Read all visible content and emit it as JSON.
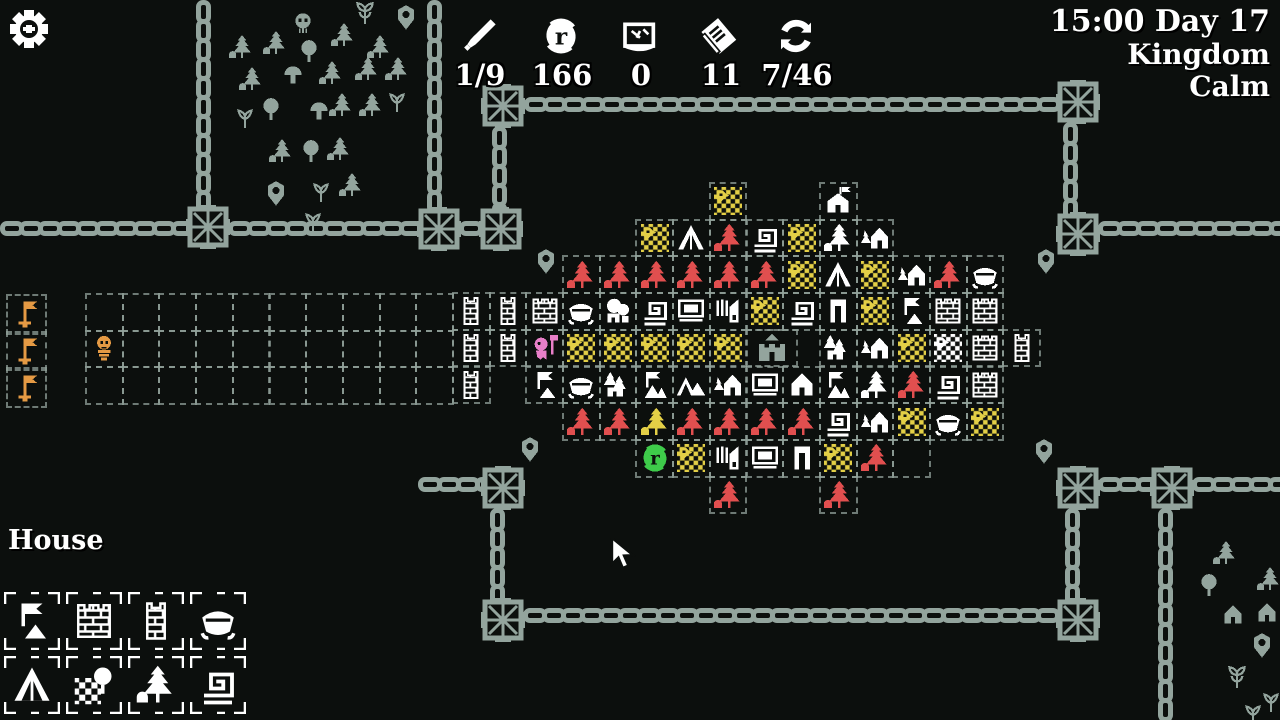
{
  "hud": {
    "resources": [
      {
        "icon": "sword-icon",
        "value": "1/9",
        "cx": 480
      },
      {
        "icon": "coin-icon",
        "value": "166",
        "cx": 562
      },
      {
        "icon": "map-icon",
        "value": "0",
        "cx": 641
      },
      {
        "icon": "deck-icon",
        "value": "11",
        "cx": 721
      },
      {
        "icon": "cycle-icon",
        "value": "7/46",
        "cx": 797
      }
    ],
    "clock": "15:00 Day 17",
    "region": "Kingdom",
    "status": "Calm"
  },
  "selection": {
    "label": "House",
    "items": [
      {
        "name": "banner",
        "col": 0,
        "row": 0
      },
      {
        "name": "wall",
        "col": 1,
        "row": 0
      },
      {
        "name": "tower",
        "col": 2,
        "row": 0
      },
      {
        "name": "boat",
        "col": 3,
        "row": 0
      },
      {
        "name": "tent",
        "col": 0,
        "row": 1
      },
      {
        "name": "white-field",
        "col": 1,
        "row": 1
      },
      {
        "name": "white-forest",
        "col": 2,
        "row": 1
      },
      {
        "name": "spiral",
        "col": 3,
        "row": 1
      }
    ]
  },
  "colors": {
    "yellow": "#e3cf46",
    "red": "#e14f4f",
    "orange": "#e59a44",
    "pink": "#e87fc8",
    "green": "#3ecb4a",
    "gray": "#93a49d",
    "white": "#ffffff",
    "bg": "#0c0f0d",
    "grid": "#94a49d"
  },
  "map": {
    "origin": {
      "x": 562,
      "y": 182
    },
    "cell": 36.7,
    "tiles": [
      {
        "c": 4,
        "r": 0,
        "t": "farm"
      },
      {
        "c": 7,
        "r": 0,
        "t": "house-flag"
      },
      {
        "c": 2,
        "r": 1,
        "t": "farm"
      },
      {
        "c": 3,
        "r": 1,
        "t": "tent"
      },
      {
        "c": 4,
        "r": 1,
        "t": "red-pine"
      },
      {
        "c": 5,
        "r": 1,
        "t": "spiral"
      },
      {
        "c": 6,
        "r": 1,
        "t": "farm"
      },
      {
        "c": 7,
        "r": 1,
        "t": "white-pine"
      },
      {
        "c": 8,
        "r": 1,
        "t": "house-tree"
      },
      {
        "c": 0,
        "r": 2,
        "t": "red-pine"
      },
      {
        "c": 1,
        "r": 2,
        "t": "red-pine"
      },
      {
        "c": 2,
        "r": 2,
        "t": "red-pine"
      },
      {
        "c": 3,
        "r": 2,
        "t": "red-pine"
      },
      {
        "c": 4,
        "r": 2,
        "t": "red-pine"
      },
      {
        "c": 5,
        "r": 2,
        "t": "red-pine"
      },
      {
        "c": 6,
        "r": 2,
        "t": "farm"
      },
      {
        "c": 7,
        "r": 2,
        "t": "tent"
      },
      {
        "c": 8,
        "r": 2,
        "t": "farm"
      },
      {
        "c": 9,
        "r": 2,
        "t": "house-tree"
      },
      {
        "c": 10,
        "r": 2,
        "t": "red-pine"
      },
      {
        "c": 11,
        "r": 2,
        "t": "boat"
      },
      {
        "c": -3,
        "r": 3,
        "t": "tower"
      },
      {
        "c": -2,
        "r": 3,
        "t": "tower"
      },
      {
        "c": -1,
        "r": 3,
        "t": "wall"
      },
      {
        "c": 0,
        "r": 3,
        "t": "boat"
      },
      {
        "c": 1,
        "r": 3,
        "t": "quarry"
      },
      {
        "c": 2,
        "r": 3,
        "t": "spiral"
      },
      {
        "c": 3,
        "r": 3,
        "t": "market"
      },
      {
        "c": 4,
        "r": 3,
        "t": "mill"
      },
      {
        "c": 5,
        "r": 3,
        "t": "farm"
      },
      {
        "c": 6,
        "r": 3,
        "t": "spiral"
      },
      {
        "c": 7,
        "r": 3,
        "t": "door"
      },
      {
        "c": 8,
        "r": 3,
        "t": "farm"
      },
      {
        "c": 9,
        "r": 3,
        "t": "banner"
      },
      {
        "c": 10,
        "r": 3,
        "t": "wall"
      },
      {
        "c": 11,
        "r": 3,
        "t": "wall"
      },
      {
        "c": -3,
        "r": 4,
        "t": "tower"
      },
      {
        "c": -2,
        "r": 4,
        "t": "tower"
      },
      {
        "c": -1,
        "r": 4,
        "t": "pink-worker"
      },
      {
        "c": 0,
        "r": 4,
        "t": "farm"
      },
      {
        "c": 1,
        "r": 4,
        "t": "farm"
      },
      {
        "c": 2,
        "r": 4,
        "t": "farm"
      },
      {
        "c": 3,
        "r": 4,
        "t": "farm"
      },
      {
        "c": 4,
        "r": 4,
        "t": "farm"
      },
      {
        "c": 5,
        "r": 4,
        "t": "castle"
      },
      {
        "c": 7,
        "r": 4,
        "t": "pines-house"
      },
      {
        "c": 8,
        "r": 4,
        "t": "house-tree"
      },
      {
        "c": 9,
        "r": 4,
        "t": "farm"
      },
      {
        "c": 10,
        "r": 4,
        "t": "white-farm"
      },
      {
        "c": 11,
        "r": 4,
        "t": "wall"
      },
      {
        "c": 12,
        "r": 4,
        "t": "tower"
      },
      {
        "c": -3,
        "r": 5,
        "t": "tower"
      },
      {
        "c": -1,
        "r": 5,
        "t": "banner"
      },
      {
        "c": 0,
        "r": 5,
        "t": "boat"
      },
      {
        "c": 1,
        "r": 5,
        "t": "pines-house"
      },
      {
        "c": 2,
        "r": 5,
        "t": "flag-bldg"
      },
      {
        "c": 3,
        "r": 5,
        "t": "double-tent"
      },
      {
        "c": 4,
        "r": 5,
        "t": "house-tree"
      },
      {
        "c": 5,
        "r": 5,
        "t": "market"
      },
      {
        "c": 6,
        "r": 5,
        "t": "house"
      },
      {
        "c": 7,
        "r": 5,
        "t": "flag-bldg"
      },
      {
        "c": 8,
        "r": 5,
        "t": "white-pine"
      },
      {
        "c": 9,
        "r": 5,
        "t": "red-pine"
      },
      {
        "c": 10,
        "r": 5,
        "t": "spiral"
      },
      {
        "c": 11,
        "r": 5,
        "t": "wall"
      },
      {
        "c": 0,
        "r": 6,
        "t": "red-pine"
      },
      {
        "c": 1,
        "r": 6,
        "t": "red-pine"
      },
      {
        "c": 2,
        "r": 6,
        "t": "yellow-pine"
      },
      {
        "c": 3,
        "r": 6,
        "t": "red-pine"
      },
      {
        "c": 4,
        "r": 6,
        "t": "red-pine"
      },
      {
        "c": 5,
        "r": 6,
        "t": "red-pine"
      },
      {
        "c": 6,
        "r": 6,
        "t": "red-pine"
      },
      {
        "c": 7,
        "r": 6,
        "t": "spiral"
      },
      {
        "c": 8,
        "r": 6,
        "t": "house-tree"
      },
      {
        "c": 9,
        "r": 6,
        "t": "farm"
      },
      {
        "c": 10,
        "r": 6,
        "t": "boat"
      },
      {
        "c": 11,
        "r": 6,
        "t": "farm"
      },
      {
        "c": 2,
        "r": 7,
        "t": "green-coin"
      },
      {
        "c": 3,
        "r": 7,
        "t": "farm"
      },
      {
        "c": 4,
        "r": 7,
        "t": "mill"
      },
      {
        "c": 5,
        "r": 7,
        "t": "market"
      },
      {
        "c": 6,
        "r": 7,
        "t": "door"
      },
      {
        "c": 7,
        "r": 7,
        "t": "farm"
      },
      {
        "c": 8,
        "r": 7,
        "t": "red-pine"
      },
      {
        "c": 9,
        "r": 7,
        "t": "empty"
      },
      {
        "c": 4,
        "r": 8,
        "t": "red-pine"
      },
      {
        "c": 7,
        "r": 8,
        "t": "red-pine"
      }
    ],
    "strip": {
      "x": 85,
      "y": 293,
      "cols": 10,
      "rows": 3
    },
    "skeleton_cell": {
      "col": 0,
      "row": 1
    },
    "flag_column": {
      "x": 6,
      "y": 294,
      "rows": 3
    },
    "pins": [
      {
        "x": 392,
        "y": 4
      },
      {
        "x": 262,
        "y": 180
      },
      {
        "x": 532,
        "y": 248
      },
      {
        "x": 1032,
        "y": 248
      },
      {
        "x": 516,
        "y": 436
      },
      {
        "x": 1030,
        "y": 438
      },
      {
        "x": 1248,
        "y": 632
      }
    ],
    "forest": [
      {
        "x": 228,
        "y": 34,
        "t": "pine"
      },
      {
        "x": 262,
        "y": 30,
        "t": "pine"
      },
      {
        "x": 330,
        "y": 22,
        "t": "pine"
      },
      {
        "x": 366,
        "y": 34,
        "t": "pine"
      },
      {
        "x": 238,
        "y": 66,
        "t": "pine"
      },
      {
        "x": 318,
        "y": 60,
        "t": "pine"
      },
      {
        "x": 354,
        "y": 56,
        "t": "pine"
      },
      {
        "x": 384,
        "y": 56,
        "t": "pine"
      },
      {
        "x": 328,
        "y": 92,
        "t": "pine"
      },
      {
        "x": 358,
        "y": 92,
        "t": "pine"
      },
      {
        "x": 268,
        "y": 138,
        "t": "pine"
      },
      {
        "x": 326,
        "y": 136,
        "t": "pine"
      },
      {
        "x": 338,
        "y": 172,
        "t": "pine"
      },
      {
        "x": 296,
        "y": 38,
        "t": "round-tree"
      },
      {
        "x": 258,
        "y": 96,
        "t": "round-tree"
      },
      {
        "x": 298,
        "y": 138,
        "t": "round-tree"
      },
      {
        "x": 290,
        "y": 10,
        "t": "skull"
      },
      {
        "x": 280,
        "y": 62,
        "t": "mushroom"
      },
      {
        "x": 306,
        "y": 98,
        "t": "mushroom"
      },
      {
        "x": 232,
        "y": 104,
        "t": "sprout"
      },
      {
        "x": 308,
        "y": 178,
        "t": "sprout"
      },
      {
        "x": 384,
        "y": 88,
        "t": "sprout"
      },
      {
        "x": 300,
        "y": 208,
        "t": "sprout"
      },
      {
        "x": 352,
        "y": 0,
        "t": "plant"
      }
    ],
    "vegetation": [
      {
        "x": 1212,
        "y": 540,
        "t": "pine"
      },
      {
        "x": 1196,
        "y": 572,
        "t": "round-tree"
      },
      {
        "x": 1256,
        "y": 566,
        "t": "pine"
      },
      {
        "x": 1220,
        "y": 602,
        "t": "house"
      },
      {
        "x": 1254,
        "y": 600,
        "t": "house"
      },
      {
        "x": 1224,
        "y": 664,
        "t": "plant"
      },
      {
        "x": 1258,
        "y": 688,
        "t": "sprout"
      },
      {
        "x": 1240,
        "y": 700,
        "t": "sprout"
      }
    ]
  },
  "chains": {
    "segments": [
      {
        "x": 196,
        "y": 0,
        "len": 212,
        "dir": "v"
      },
      {
        "x": 427,
        "y": 0,
        "len": 210,
        "dir": "v"
      },
      {
        "x": 492,
        "y": 126,
        "len": 84,
        "dir": "v"
      },
      {
        "x": 1063,
        "y": 122,
        "len": 92,
        "dir": "v"
      },
      {
        "x": 490,
        "y": 508,
        "len": 92,
        "dir": "v"
      },
      {
        "x": 1065,
        "y": 508,
        "len": 92,
        "dir": "v"
      },
      {
        "x": 1158,
        "y": 508,
        "len": 212,
        "dir": "v"
      },
      {
        "x": 0,
        "y": 221,
        "len": 190,
        "dir": "h"
      },
      {
        "x": 228,
        "y": 221,
        "len": 192,
        "dir": "h"
      },
      {
        "x": 459,
        "y": 221,
        "len": 26,
        "dir": "h"
      },
      {
        "x": 524,
        "y": 97,
        "len": 534,
        "dir": "h"
      },
      {
        "x": 1098,
        "y": 221,
        "len": 182,
        "dir": "h"
      },
      {
        "x": 418,
        "y": 477,
        "len": 66,
        "dir": "h"
      },
      {
        "x": 523,
        "y": 608,
        "len": 536,
        "dir": "h"
      },
      {
        "x": 1098,
        "y": 477,
        "len": 56,
        "dir": "h"
      },
      {
        "x": 1192,
        "y": 477,
        "len": 88,
        "dir": "h"
      }
    ],
    "knots": [
      {
        "x": 186,
        "y": 205
      },
      {
        "x": 417,
        "y": 207
      },
      {
        "x": 479,
        "y": 207
      },
      {
        "x": 481,
        "y": 84
      },
      {
        "x": 1056,
        "y": 80
      },
      {
        "x": 1056,
        "y": 212
      },
      {
        "x": 481,
        "y": 466
      },
      {
        "x": 481,
        "y": 598
      },
      {
        "x": 1056,
        "y": 466
      },
      {
        "x": 1056,
        "y": 598
      },
      {
        "x": 1150,
        "y": 466
      }
    ]
  },
  "cursor": {
    "x": 610,
    "y": 538
  }
}
